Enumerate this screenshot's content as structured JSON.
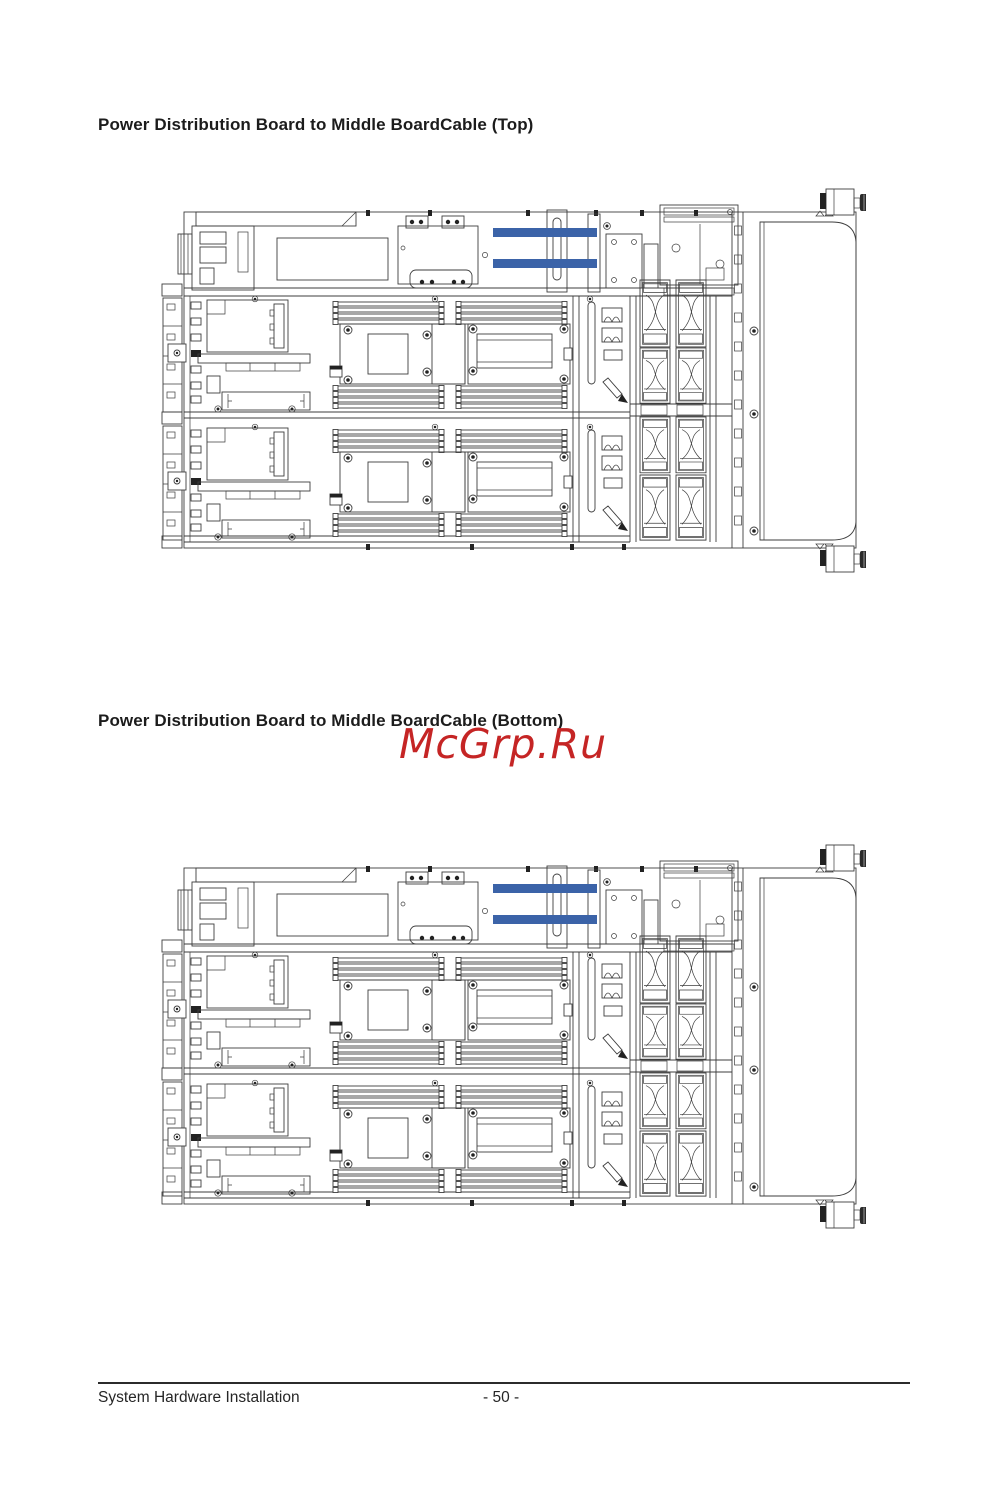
{
  "page": {
    "sections": [
      {
        "title": "Power Distribution Board to Middle BoardCable (Top)"
      },
      {
        "title": "Power Distribution Board to Middle BoardCable (Bottom)"
      }
    ],
    "watermark": "McGrp.Ru",
    "footer": {
      "left_text": "System Hardware Installation",
      "page_number": "- 50 -"
    }
  },
  "colors": {
    "cable-highlight": "#3b63a8",
    "watermark-red": "#c52525",
    "diagram-line": "#3d3d3d",
    "text": "#1c1c1c"
  }
}
